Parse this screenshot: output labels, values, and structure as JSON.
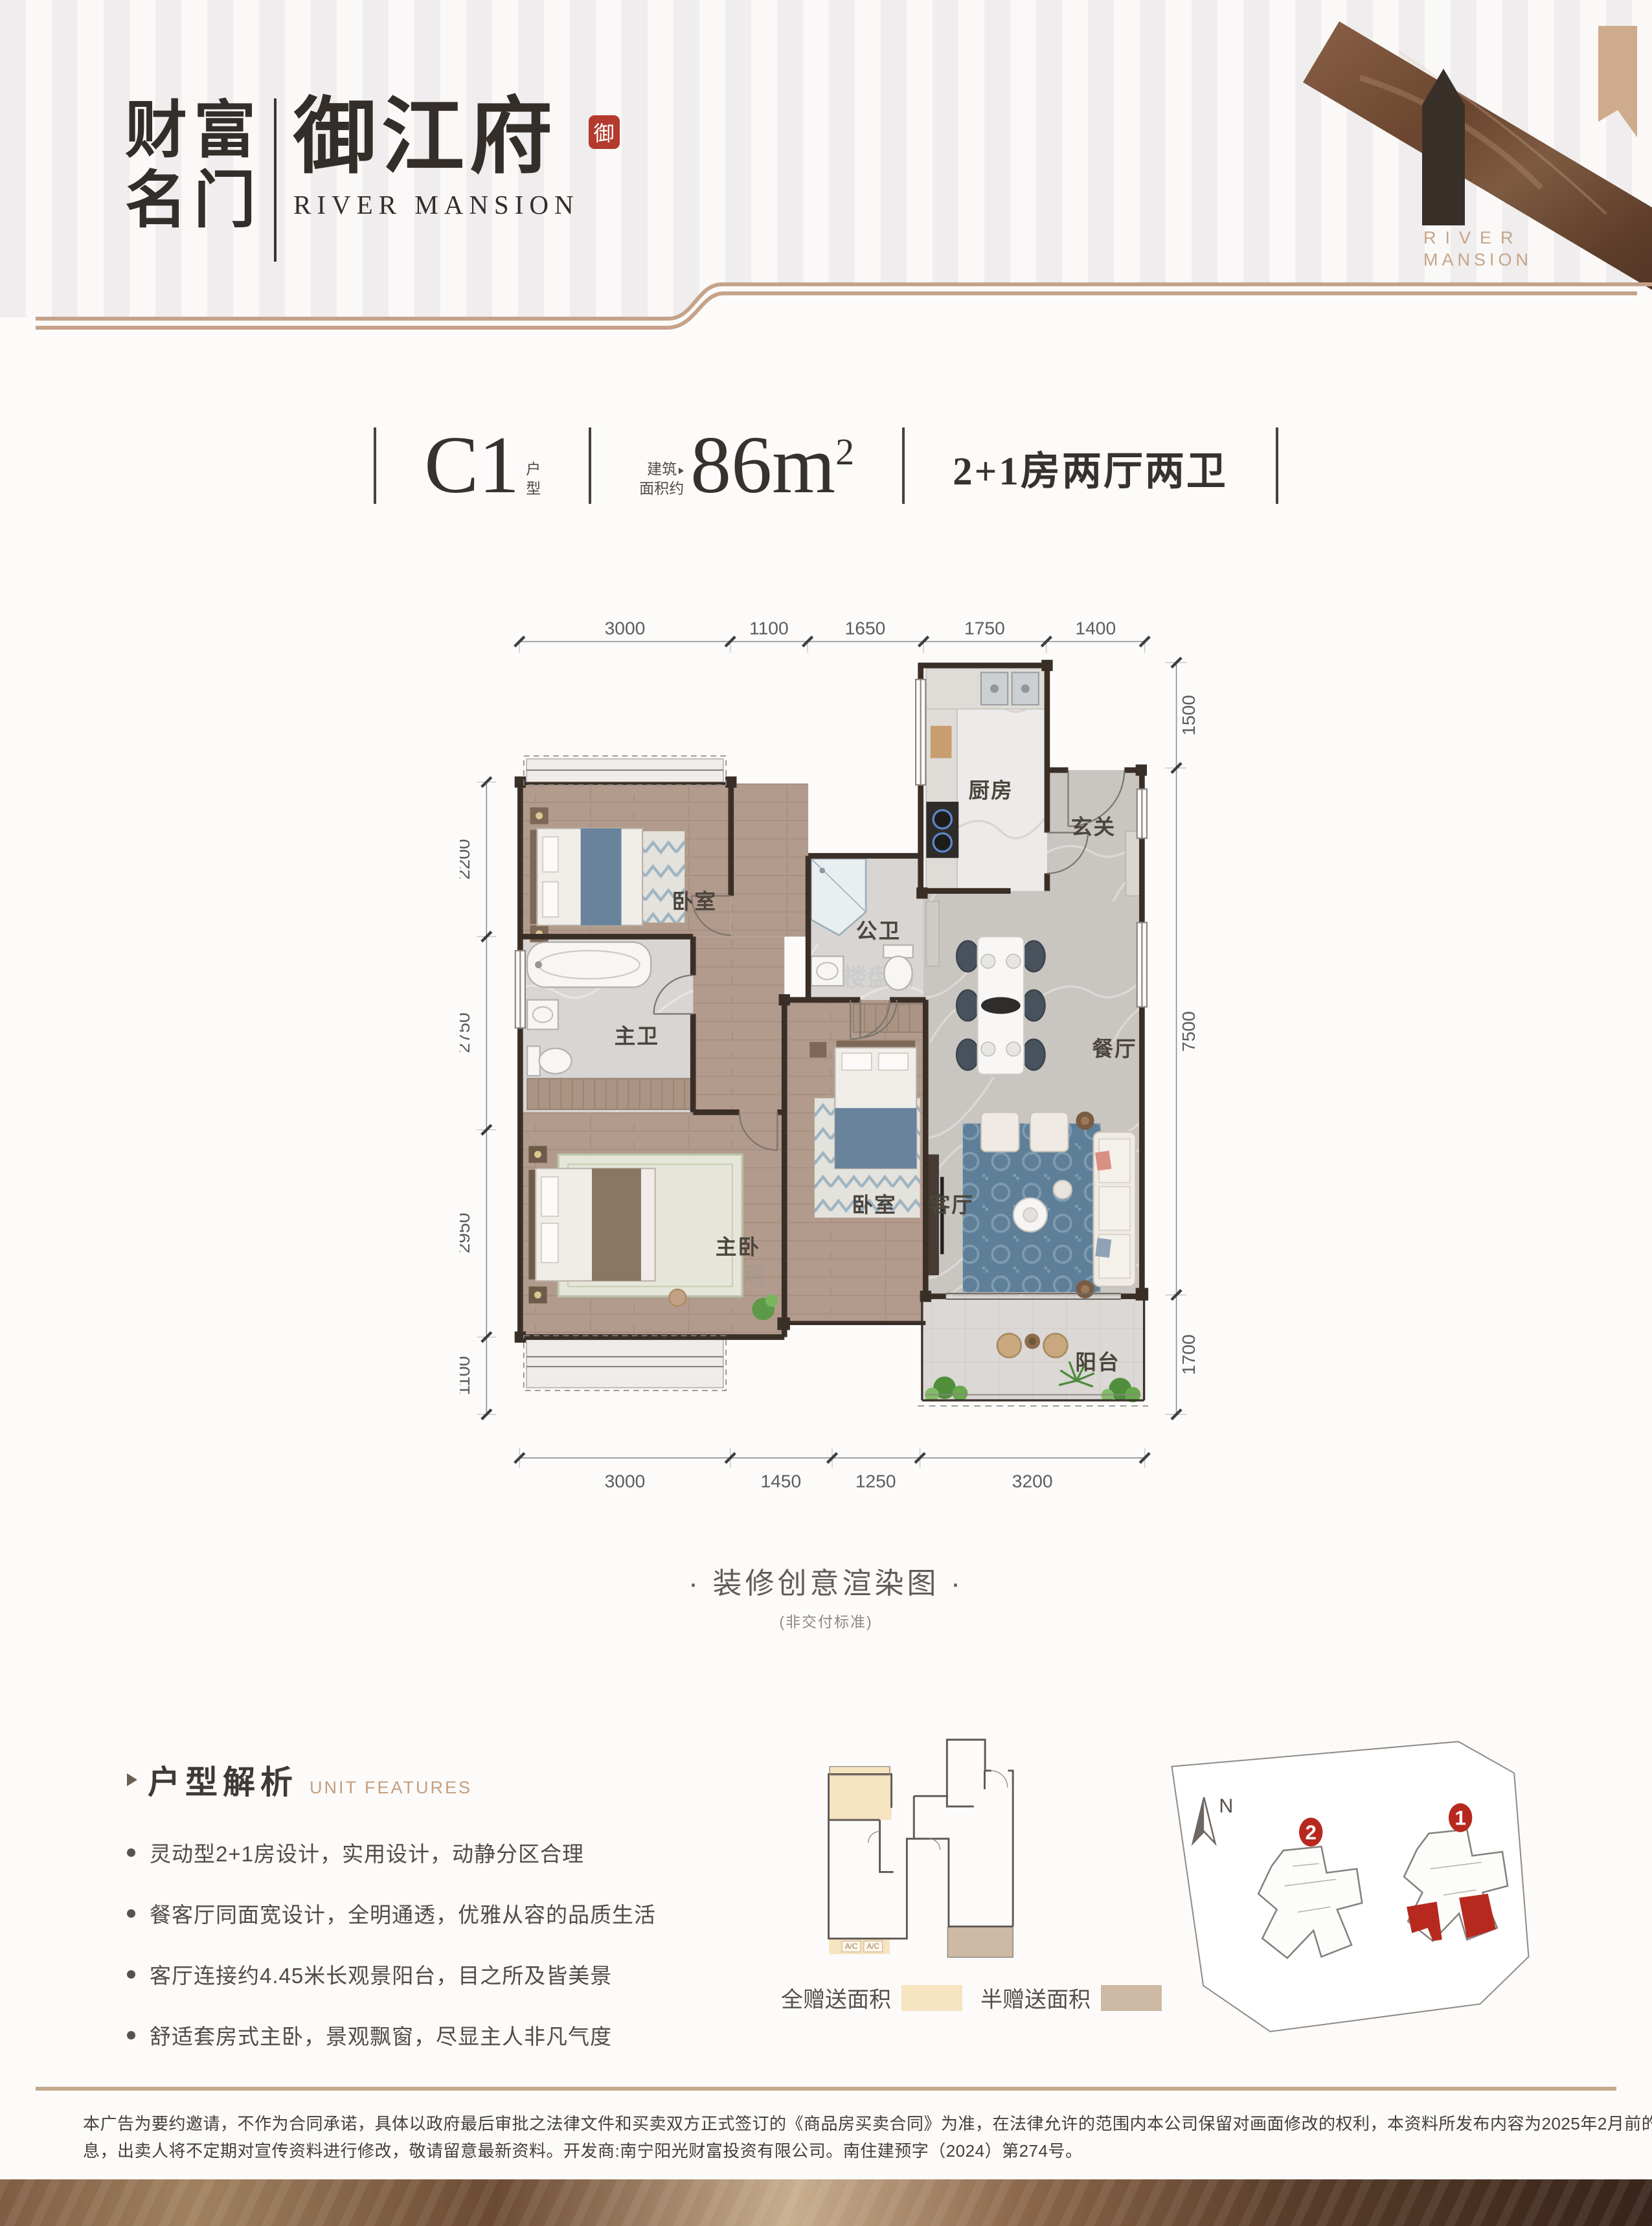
{
  "header": {
    "brand_line1": "财富",
    "brand_line2": "名门",
    "brand_cn": "御江府",
    "brand_en": "RIVER MANSION",
    "seal": "御",
    "decor_en_line1": "RIVER",
    "decor_en_line2": "MANSION"
  },
  "title": {
    "unit": "C1",
    "unit_suffix_l1": "户",
    "unit_suffix_l2": "型",
    "area_label_l1": "建筑",
    "area_label_l2": "面积约",
    "area_value": "86m",
    "area_sup": "2",
    "layout": "2+1房两厅两卫"
  },
  "floorplan": {
    "rooms": {
      "kitchen": "厨房",
      "foyer": "玄关",
      "guest_bath": "公卫",
      "dining": "餐厅",
      "bedroom": "卧室",
      "master_bath": "主卫",
      "master_bedroom": "主卧",
      "living": "客厅",
      "balcony": "阳台"
    },
    "dims": {
      "top": [
        "3000",
        "1100",
        "1650",
        "1750",
        "1400"
      ],
      "right": [
        "1500",
        "7500",
        "1700"
      ],
      "left": [
        "2200",
        "2750",
        "2950",
        "1100"
      ],
      "bottom": [
        "3000",
        "1450",
        "1250",
        "3200"
      ]
    },
    "watermark": "楼盘网",
    "caption": "· 装修创意渲染图 ·",
    "caption_note": "(非交付标准)"
  },
  "features": {
    "title_cn": "户型解析",
    "title_en": "UNIT FEATURES",
    "items": [
      "灵动型2+1房设计，实用设计，动静分区合理",
      "餐客厅同面宽设计，全明通透，优雅从容的品质生活",
      "客厅连接约4.45米长观景阳台，目之所及皆美景",
      "舒适套房式主卧，景观飘窗，尽显主人非凡气度"
    ]
  },
  "legend": {
    "full_label": "全赠送面积",
    "half_label": "半赠送面积",
    "full_color": "#f6e4c0",
    "half_color": "#cdb9a4",
    "ac_label": "A/C"
  },
  "siteplan": {
    "north_label": "N",
    "badges": [
      "2",
      "1"
    ],
    "accent_color": "#b7291f"
  },
  "footer": {
    "line1": "本广告为要约邀请，不作为合同承诺，具体以政府最后审批之法律文件和买卖双方正式签订的《商品房买卖合同》为准，在法律允许的范围内本公司保留对画面修改的权利，本资料所发布内容为2025年2月前的信",
    "line2": "息，出卖人将不定期对宣传资料进行修改，敬请留意最新资料。开发商:南宁阳光财富投资有限公司。南住建预字（2024）第274号。"
  },
  "colors": {
    "accent_tan": "#c5a289",
    "seal_red": "#b43a2e",
    "wall": "#3a2f27"
  }
}
